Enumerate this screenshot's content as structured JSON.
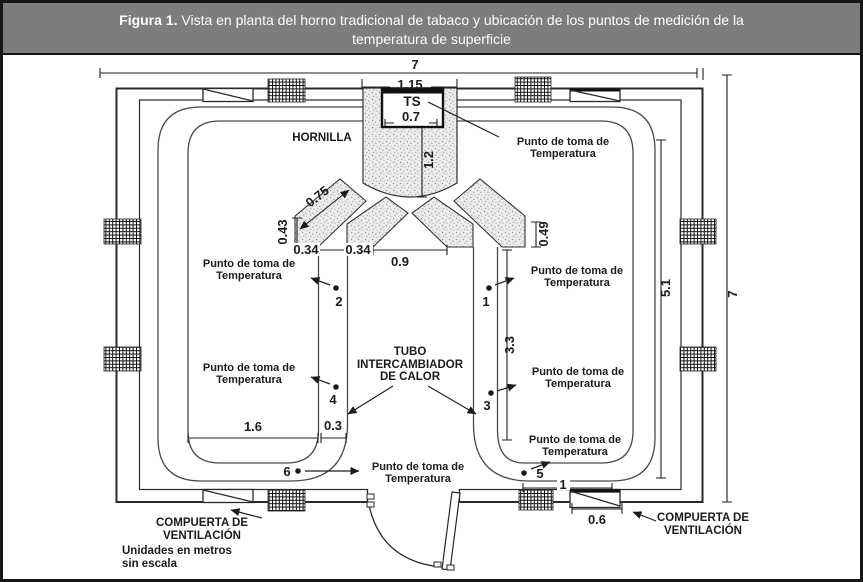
{
  "figure": {
    "title_bold": "Figura 1.",
    "title_rest": " Vista en planta del horno tradicional de tabaco y ubicación de los puntos de medición de la",
    "title_line2": "temperatura de superficie"
  },
  "labels": {
    "hornilla": "HORNILLA",
    "ts": "TS",
    "temp_point_line1": "Punto de toma de",
    "temp_point_line2": "Temperatura",
    "tube_line1": "TUBO",
    "tube_line2": "INTERCAMBIADOR",
    "tube_line3": "DE CALOR",
    "vent_gate_line1": "COMPUERTA DE",
    "vent_gate_line2": "VENTILACIÓN",
    "units_line1": "Unidades en metros",
    "units_line2": "sin escala"
  },
  "dimensions": {
    "total_width": "7",
    "total_height": "7",
    "chimney_width": "1.15",
    "ts_width": "0.7",
    "chimney_depth": "1.2",
    "duct_length": "0.75",
    "left_outlet_height": "0.43",
    "right_outlet_height": "0.49",
    "outlet_left_a": "0.34",
    "outlet_left_b": "0.34",
    "center_span": "0.9",
    "tube_run": "3.3",
    "inner_height": "5.1",
    "bottom_left_span": "1.6",
    "tube_width": "0.3",
    "door_span": "1",
    "gate_width": "0.6"
  },
  "points": {
    "p1": "1",
    "p2": "2",
    "p3": "3",
    "p4": "4",
    "p5": "5",
    "p6": "6"
  },
  "colors": {
    "title_bar_bg": "#7d7d7d",
    "title_text": "#ffffff",
    "frame_border": "#161616",
    "line_color": "#2a2a2a",
    "stipple_bg": "#ececec"
  }
}
